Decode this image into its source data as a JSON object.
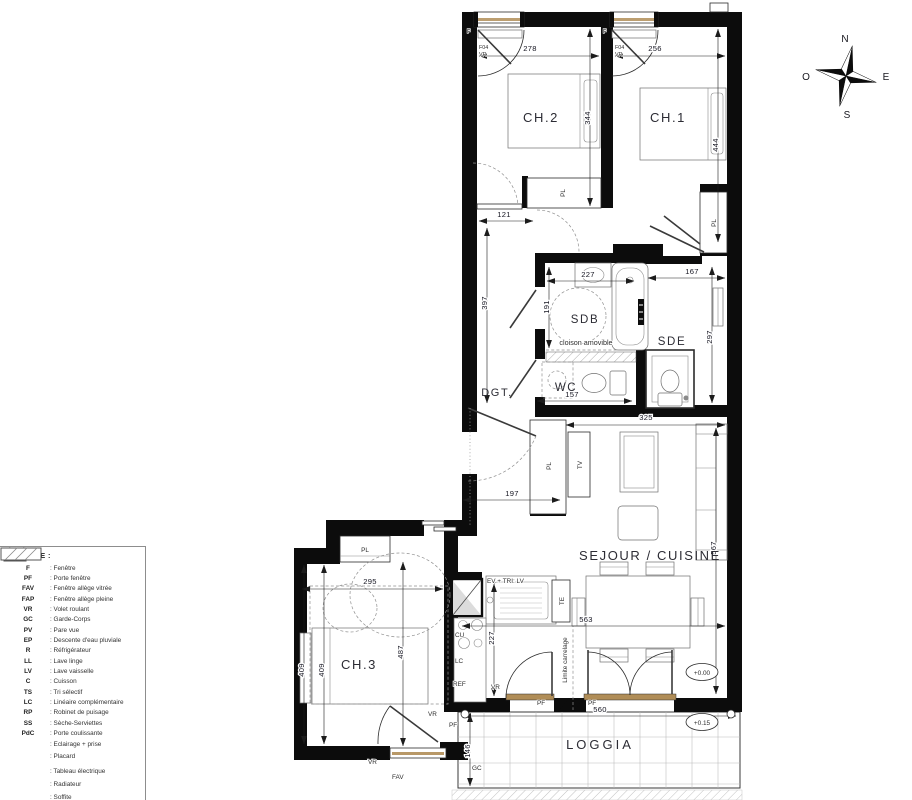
{
  "rooms": {
    "ch2": "CH.2",
    "ch1": "CH.1",
    "sdb": "SDB",
    "sde": "SDE",
    "wc": "WC",
    "dgt": "DGT.",
    "sejour": "SEJOUR / CUISINE",
    "ch3": "CH.3",
    "loggia": "LOGGIA"
  },
  "dims": {
    "ch2_w": "278",
    "ch1_w": "256",
    "ch2_h": "344",
    "ch1_h": "444",
    "hall_w": "121",
    "dgt_h": "397",
    "sdb_w": "227",
    "sdb_h": "191",
    "sde_w": "167",
    "sde_h": "297",
    "wc_w": "157",
    "sejour_top_w": "325",
    "entry_w": "197",
    "sejour_h": "567",
    "sejour_w": "563",
    "ch3_w": "295",
    "ch3_h_a": "409",
    "ch3_h_b": "409",
    "ch3_h": "487",
    "kitchen_h": "227",
    "loggia_w": "560",
    "loggia_h": "146"
  },
  "labels": {
    "f": "F",
    "f04": "F04",
    "vr": "VR",
    "pl": "PL",
    "tv": "TV",
    "ev_tri": "EV + TRI: LV",
    "te": "TE",
    "cu": "CU",
    "lc": "LC",
    "ref": "REF",
    "pf": "PF",
    "fav": "FAV",
    "gc": "GC",
    "ep": "EP",
    "cloison": "cloison amovible",
    "limite": "Limite carrelage",
    "level_sejour": "+0.00",
    "level_loggia": "+0.15"
  },
  "compass": {
    "n": "N",
    "e": "E",
    "s": "S",
    "o": "O"
  },
  "legend": {
    "title": "LEGENDE :",
    "items": [
      {
        "code": "F",
        "desc": ": Fenêtre"
      },
      {
        "code": "PF",
        "desc": ": Porte fenêtre"
      },
      {
        "code": "FAV",
        "desc": ": Fenêtre allège vitrée"
      },
      {
        "code": "FAP",
        "desc": ": Fenêtre allège pleine"
      },
      {
        "code": "VR",
        "desc": ": Volet roulant"
      },
      {
        "code": "GC",
        "desc": ": Garde-Corps"
      },
      {
        "code": "PV",
        "desc": ": Pare vue"
      },
      {
        "code": "EP",
        "desc": ": Descente d'eau pluviale"
      },
      {
        "code": "R",
        "desc": ": Réfrigérateur"
      },
      {
        "code": "LL",
        "desc": ": Lave linge"
      },
      {
        "code": "LV",
        "desc": ": Lave vaisselle"
      },
      {
        "code": "C",
        "desc": ": Cuisson"
      },
      {
        "code": "TS",
        "desc": ": Tri sélectif"
      },
      {
        "code": "LC",
        "desc": ": Linéaire complémentaire"
      },
      {
        "code": "RP",
        "desc": ": Robinet de puisage"
      },
      {
        "code": "SS",
        "desc": ": Sèche-Serviettes"
      },
      {
        "code": "PdC",
        "desc": ": Porte coulissante"
      }
    ],
    "symbols": [
      {
        "name": "eclairage-prise",
        "desc": ": Eclairage + prise"
      },
      {
        "name": "placard",
        "desc": ": Placard"
      },
      {
        "name": "tableau-electrique",
        "desc": ": Tableau électrique"
      },
      {
        "name": "radiateur",
        "desc": ": Radiateur"
      },
      {
        "name": "soffite",
        "desc": ": Soffite"
      }
    ]
  }
}
